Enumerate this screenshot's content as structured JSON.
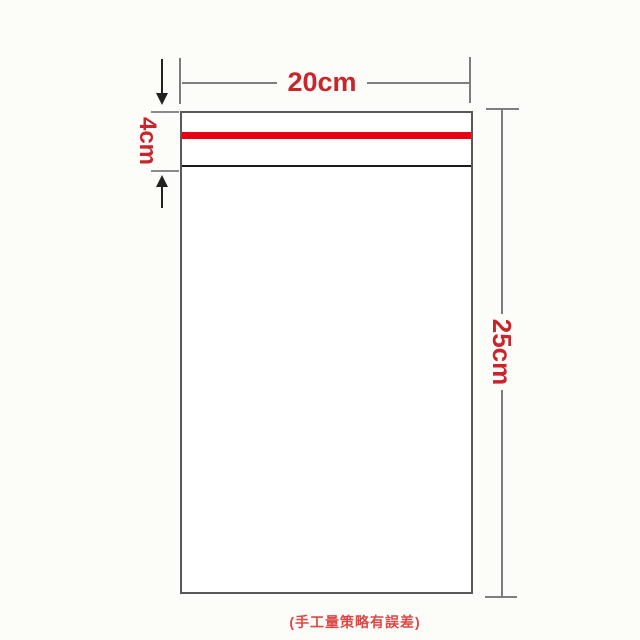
{
  "diagram": {
    "title_hint": "self-seal bag dimension diagram",
    "width_label": "20cm",
    "flap_label": "4cm",
    "height_label": "25cm",
    "note": "(手工量策略有誤差)",
    "colors": {
      "dimension_text_red": "#c9252d",
      "adhesive_strip_red": "#e50012",
      "note_red": "#dc4848",
      "dimension_line_gray": "#7d7d7f",
      "bag_outline_gray": "#59595b",
      "flap_line_black": "#1b1b1b",
      "background": "#fcfcf8",
      "bag_fill": "#ffffff"
    }
  }
}
